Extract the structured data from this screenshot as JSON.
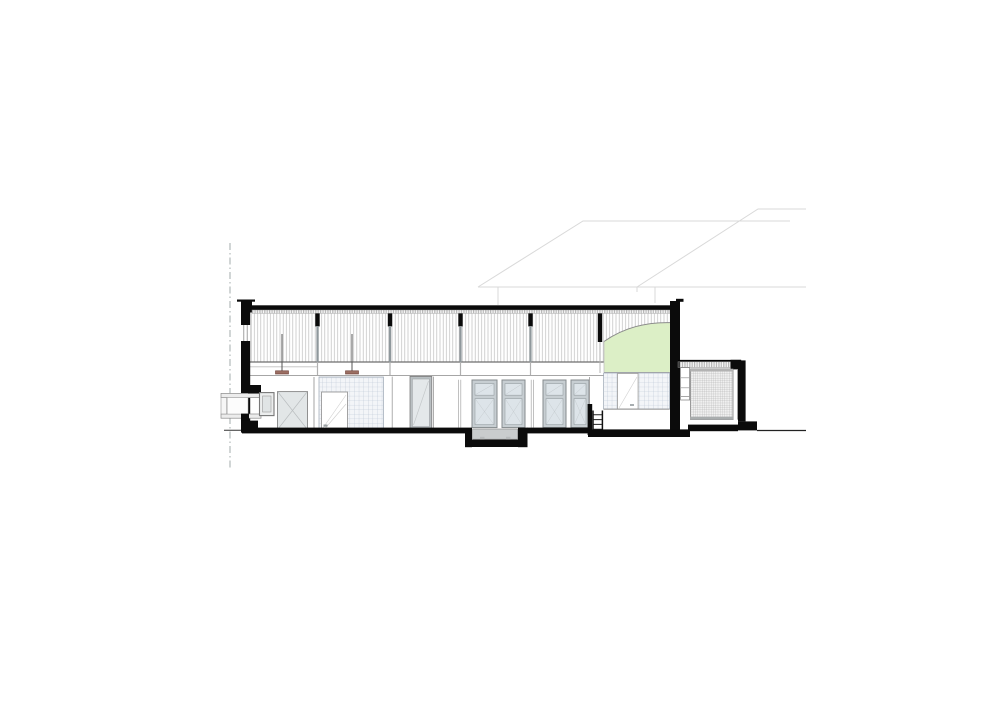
{
  "page": {
    "background": "#ffffff"
  },
  "drawing": {
    "type": "architectural-section",
    "description": "Cross-section through a single-storey hall with clerestory glazing, a green barrel-vault rooflight, tiled service walls, a sunken pit at grade and a lower annex with a mesh screen wall; faint hipped roofs of neighbouring volumes appear behind the section.",
    "visible_text": [],
    "counts": {
      "background_roofs": 2,
      "clerestory_columns": 5,
      "pendant_lights": 2,
      "casement_windows": 4,
      "doors": 4,
      "ladder_rungs": 4
    }
  },
  "colors": {
    "paper": "#ffffff",
    "poche": "#0b0b0b",
    "accent_green": "#dcefc6",
    "pendant_red": "#9b6f63",
    "glass": "#dde4e9",
    "glass_frame": "#868b8e",
    "tile_face": "#f3f5f8",
    "tile_line": "#b5c1d1",
    "mesh_face": "#f0f0f0",
    "mesh_line": "#a8a8a8",
    "hatch_line": "#bdbdbd",
    "faint_roof": "#d9d9d9",
    "ground_line": "#2e2e2e",
    "boundary_line": "#9aa3a3"
  }
}
